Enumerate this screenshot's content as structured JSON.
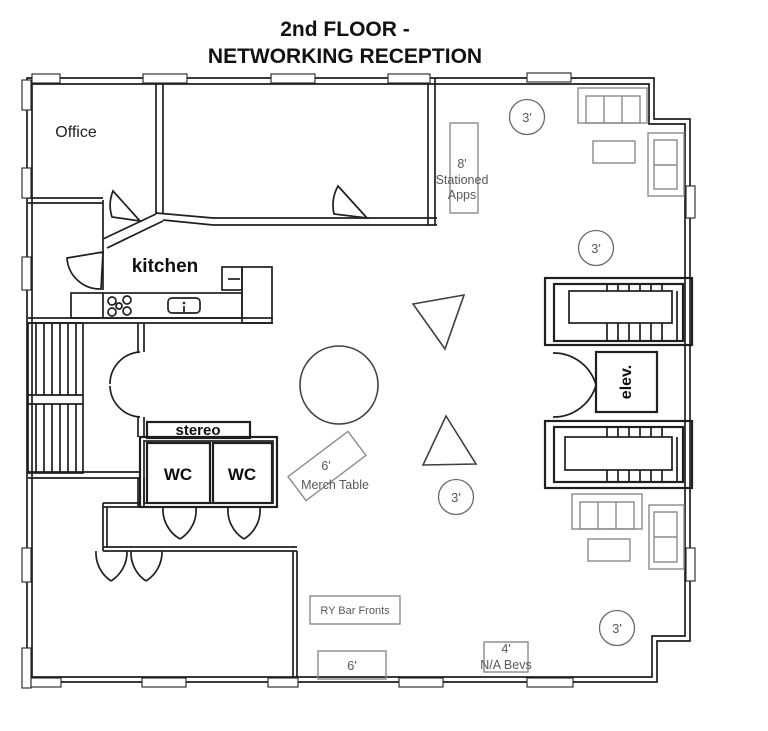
{
  "title": {
    "line1": "2nd FLOOR -",
    "line2": "NETWORKING RECEPTION"
  },
  "rooms": {
    "office": "Office",
    "kitchen": "kitchen",
    "stereo": "stereo",
    "wc_left": "WC",
    "wc_right": "WC",
    "elevator": "elev."
  },
  "annotations": {
    "stationed_apps": {
      "size": "8'",
      "line1": "Stationed",
      "line2": "Apps"
    },
    "circle_top": "3'",
    "circle_mid": "3'",
    "circle_center": "3'",
    "circle_bottom": "3'",
    "merch_table": {
      "size": "6'",
      "label": "Merch Table"
    },
    "ry_bar_fronts": "RY Bar Fronts",
    "bar_front_size": "6'",
    "na_bevs": {
      "size": "4'",
      "label": "N/A Bevs"
    }
  },
  "colors": {
    "wall": "#1f1f1f",
    "furniture": "#8a8a8a",
    "annotation_text": "#595959",
    "label_text": "#111111",
    "background": "#ffffff"
  }
}
